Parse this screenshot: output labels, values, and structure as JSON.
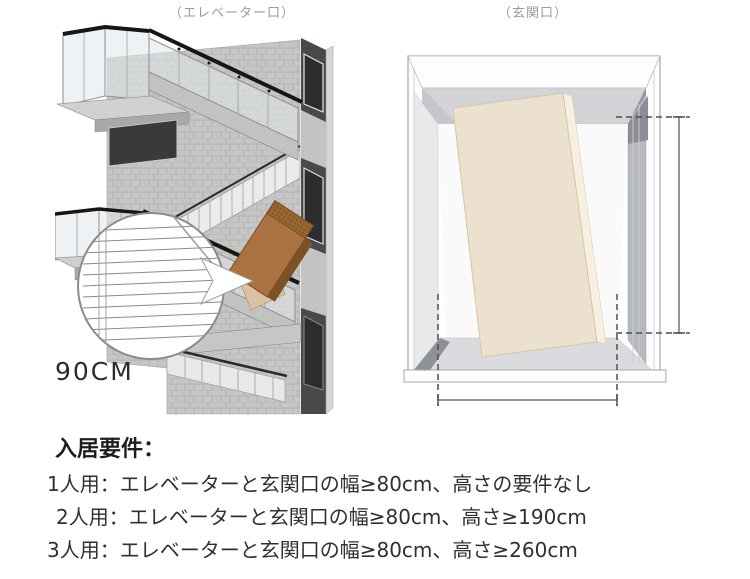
{
  "figures": {
    "elevator": {
      "caption": "（エレベーター口）",
      "width_label": "90CM",
      "box_color": "#aa7240",
      "wall_color": "#c6c6c4",
      "handrail_color": "#161616"
    },
    "entrance": {
      "caption": "（玄関口）",
      "panel_color": "#ece0ce",
      "floor_color": "#d9dbdf",
      "dimension_line_color": "#4f4f4f"
    }
  },
  "requirements": {
    "heading": "入居要件：",
    "items": [
      {
        "label": "1人用：エレベーターと玄関口の幅≥80cm、高さの要件なし"
      },
      {
        "label": "2人用：エレベーターと玄関口の幅≥80cm、高さ≥190cm"
      },
      {
        "label": "3人用：エレベーターと玄関口の幅≥80cm、高さ≥260cm"
      }
    ]
  },
  "colors": {
    "background": "#ffffff",
    "caption_gray": "#9b9b9b",
    "text_primary": "#2d2d2d"
  }
}
